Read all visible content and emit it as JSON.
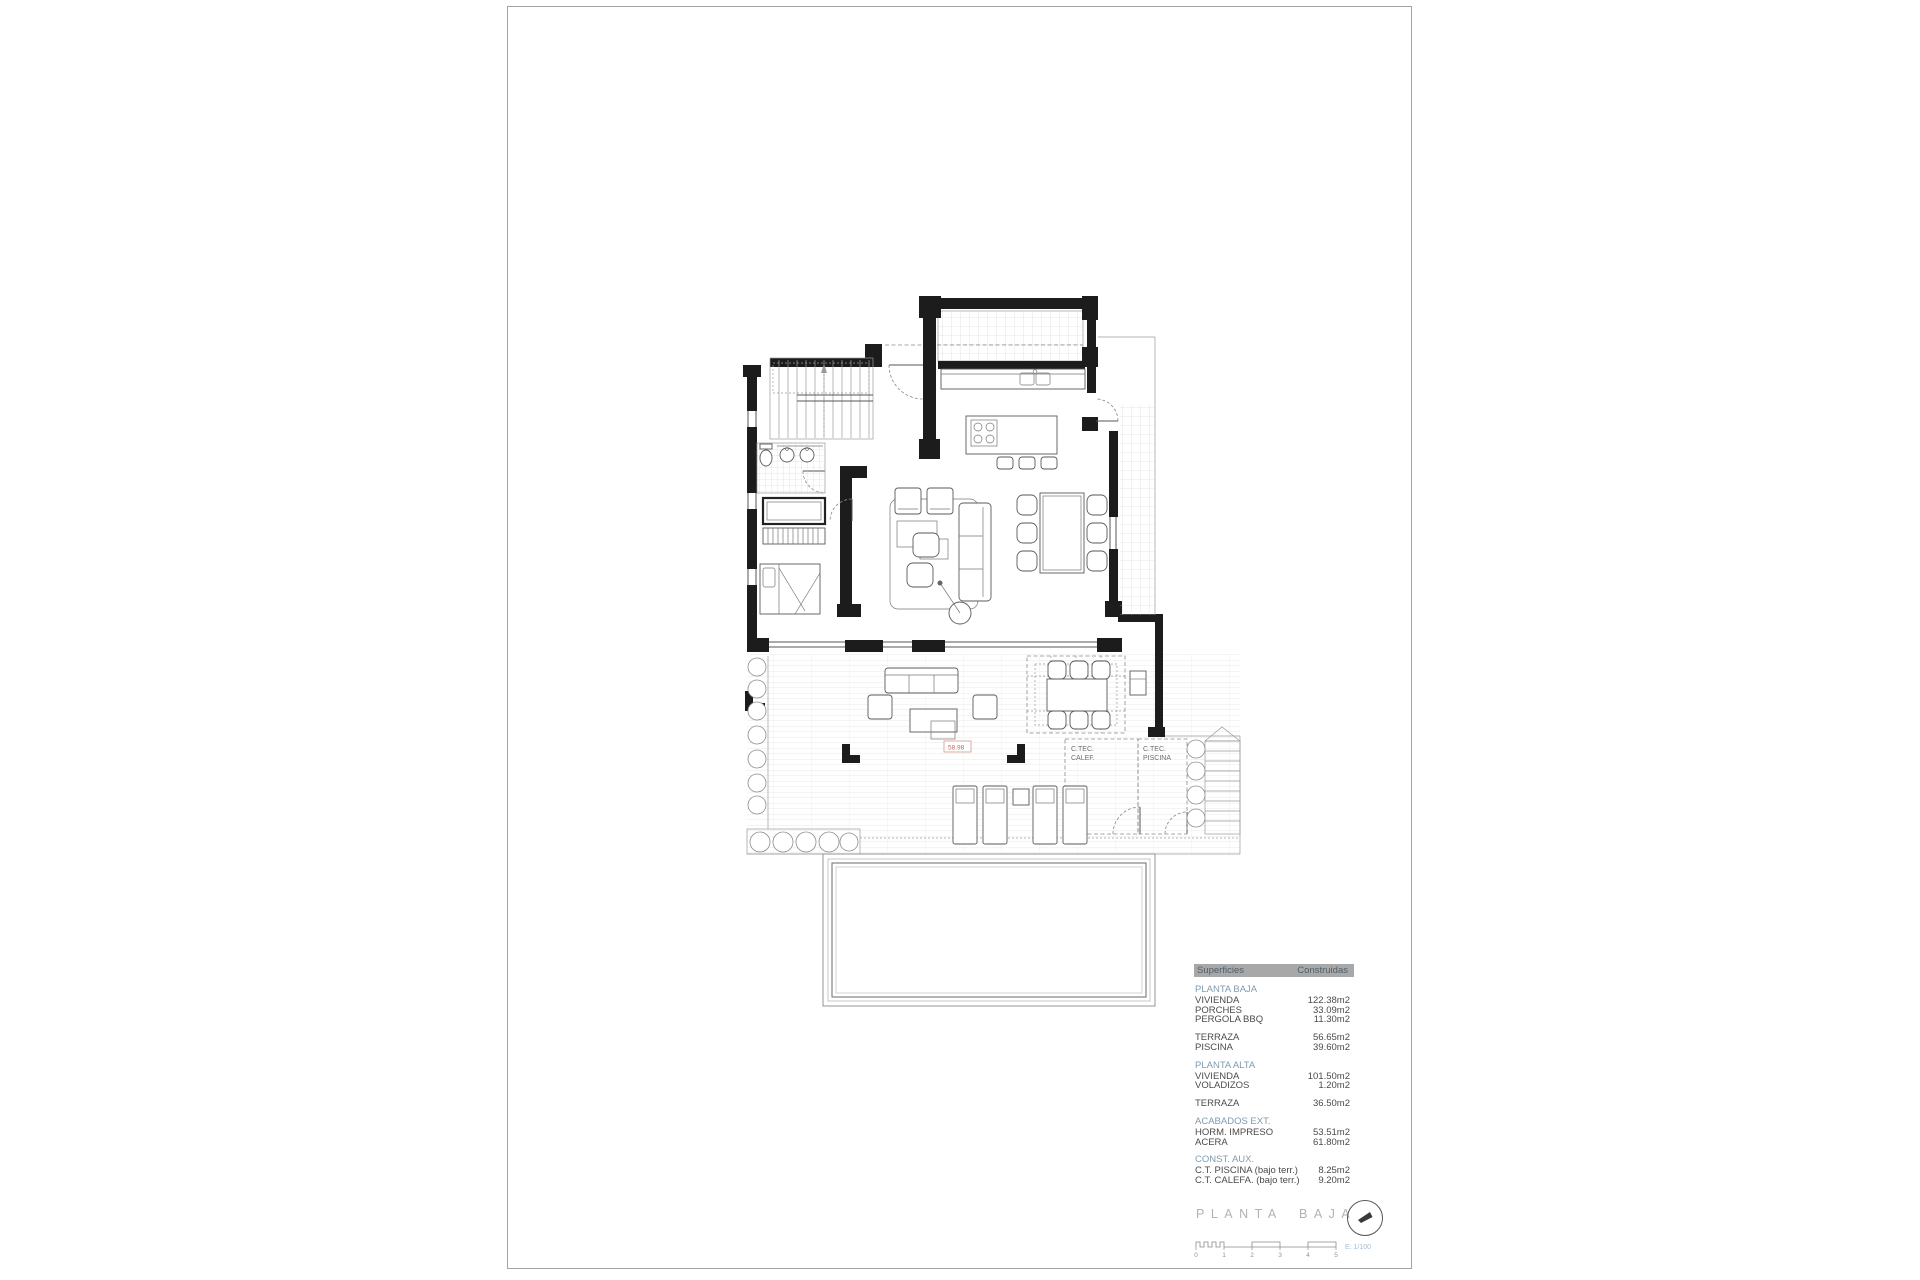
{
  "title_block": {
    "title": "PLANTA BAJA",
    "scale_label": "E: 1/100",
    "scale_ticks": [
      "0",
      "1",
      "2",
      "3",
      "4",
      "5"
    ]
  },
  "areas": {
    "header": {
      "label": "Superficies",
      "value": "Construidas"
    },
    "sections": [
      {
        "title": "PLANTA BAJA",
        "rows": [
          {
            "label": "VIVIENDA",
            "value": "122.38m2"
          },
          {
            "label": "PORCHES",
            "value": "33.09m2"
          },
          {
            "label": "PERGOLA BBQ",
            "value": "11.30m2"
          }
        ]
      },
      {
        "title": "",
        "rows": [
          {
            "label": "TERRAZA",
            "value": "56.65m2"
          },
          {
            "label": "PISCINA",
            "value": "39.60m2"
          }
        ]
      },
      {
        "title": "PLANTA ALTA",
        "rows": [
          {
            "label": "VIVIENDA",
            "value": "101.50m2"
          },
          {
            "label": "VOLADIZOS",
            "value": "1.20m2"
          }
        ]
      },
      {
        "title": "",
        "rows": [
          {
            "label": "TERRAZA",
            "value": "36.50m2"
          }
        ]
      },
      {
        "title": "ACABADOS EXT.",
        "rows": [
          {
            "label": "HORM. IMPRESO",
            "value": "53.51m2"
          },
          {
            "label": "ACERA",
            "value": "61.80m2"
          }
        ]
      },
      {
        "title": "CONST. AUX.",
        "rows": [
          {
            "label": "C.T. PISCINA (bajo terr.)",
            "value": "8.25m2"
          },
          {
            "label": "C.T. CALEFA. (bajo terr.)",
            "value": "9.20m2"
          }
        ]
      }
    ]
  },
  "plan": {
    "labels": {
      "calef_line1": "C.TEC.",
      "calef_line2": "CALEF.",
      "piscina_line1": "C.TEC.",
      "piscina_line2": "PISCINA",
      "level_mark": "58.98"
    }
  },
  "colors": {
    "wall": "#1c1c1c",
    "table_header_bg": "#a8a8a8",
    "section_blue": "#7e9cb2",
    "level_red": "#c4635a",
    "title_gray": "#b2b2b2"
  }
}
